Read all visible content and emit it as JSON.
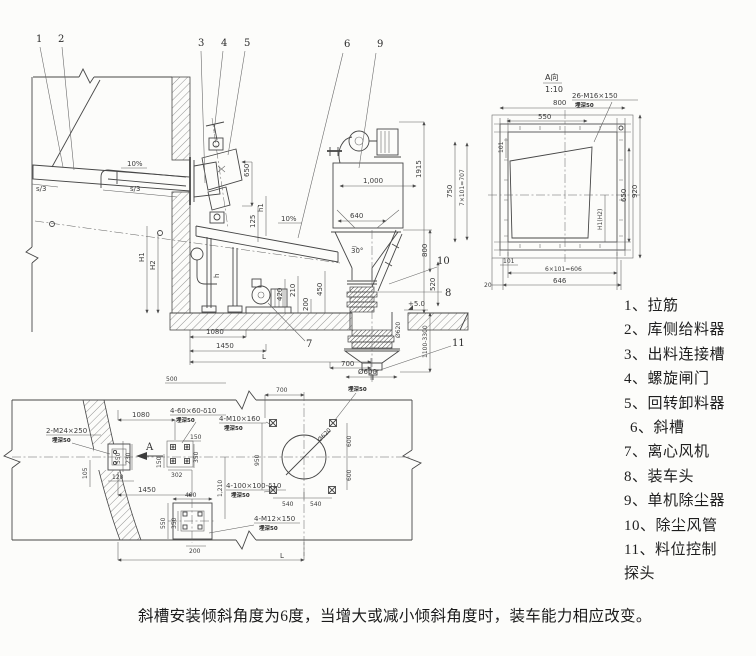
{
  "legend": {
    "items": [
      "1、拉筋",
      "2、库侧给料器",
      "3、出料连接槽",
      "4、螺旋闸门",
      "5、回转卸料器",
      "6、斜槽",
      "7、离心风机",
      "8、装车头",
      "9、单机除尘器",
      "10、除尘风管",
      "11、料位控制",
      "探头"
    ]
  },
  "caption": {
    "text": "斜槽安装倾斜角度为6度，当增大或减小倾斜角度时，装车能力相应改变。"
  },
  "elevation": {
    "callouts": {
      "c1": "1",
      "c2": "2",
      "c3": "3",
      "c4": "4",
      "c5": "5",
      "c6": "6",
      "c7": "7",
      "c8": "8",
      "c9": "9",
      "c10": "10",
      "c11": "11"
    },
    "dims": {
      "slope_pipe": "10%",
      "slope_chute": "10%",
      "s3_left": "s/3",
      "s3_mid": "s/3",
      "H1": "H1",
      "H2": "H2",
      "d650": "650",
      "d125": "125",
      "h1": "h1",
      "h": "h",
      "deg30": "30°",
      "d1000": "1,000",
      "d640": "640",
      "d1915": "1915",
      "d800": "800",
      "d520": "520",
      "level": "+5.0",
      "range": "1100-3300",
      "dia620": "Ø620",
      "dia600": "Ø600",
      "d700": "700",
      "d1080": "1080",
      "d1450": "1450",
      "L": "L",
      "d420": "420",
      "d210": "210",
      "d450": "450",
      "d200": "200",
      "t500": "500"
    }
  },
  "detail": {
    "title": "A向",
    "scale": "1:10",
    "bolts": "26-M16×150",
    "bolts_note": "埋深50",
    "d800": "800",
    "d550": "550",
    "d750": "750",
    "d707": "7×101=707",
    "d101t": "101",
    "d920": "920",
    "d650": "650",
    "dh": "H1(H2)",
    "d101b": "101",
    "d606": "6×101=606",
    "d646": "646",
    "d20": "20"
  },
  "plan": {
    "labels": {
      "m24": "2-M24×250",
      "m24_note": "埋深50",
      "g60": "4-60×60-δ10",
      "g60_note": "埋深50",
      "m10": "4-M10×160",
      "m10_note": "埋深50",
      "m10_note2": "埋深50",
      "g100": "4-100×100-δ10",
      "g100_note": "埋深50",
      "m12": "4-M12×150",
      "m12_note": "埋深50",
      "A": "A"
    },
    "dims": {
      "d1080": "1080",
      "d550": "550",
      "d230": "230",
      "d120": "120",
      "d105": "105",
      "d1450": "1450",
      "d150a": "150",
      "d302": "302",
      "d150b": "150",
      "d350": "350",
      "d700": "700",
      "d950": "950",
      "d600a": "600",
      "d600b": "600",
      "dia620": "Ø620",
      "d540a": "540",
      "d540b": "540",
      "d1210": "1,210",
      "d400": "400",
      "d550b": "550",
      "d350b": "350",
      "d200": "200",
      "L": "L"
    }
  }
}
